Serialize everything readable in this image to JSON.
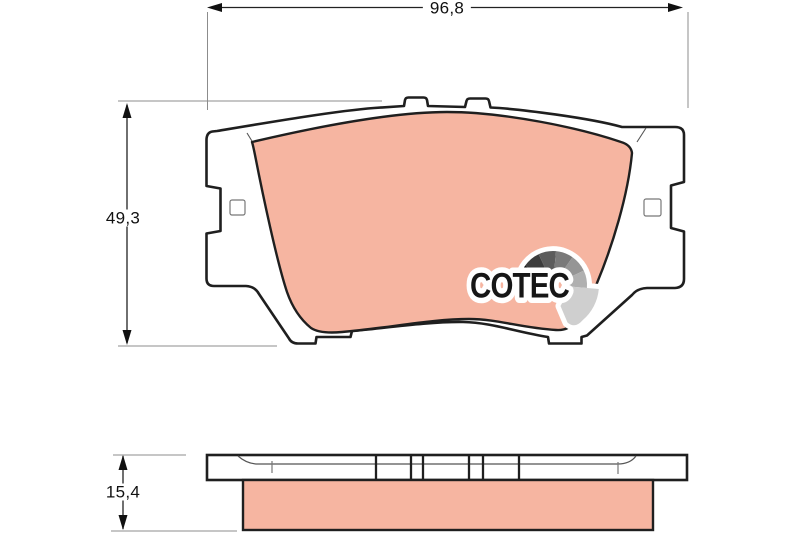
{
  "dimensions": {
    "width": "96,8",
    "height": "49,3",
    "thickness": "15,4"
  },
  "logo": {
    "text": "COTEC"
  },
  "colors": {
    "friction_material": "#f6b5a1",
    "outline": "#1f1f1f",
    "dimension_line": "#8c8c8c",
    "logo_text": "#161616",
    "logo_fan": [
      "#111111",
      "#3d3d3d",
      "#5c5c5c",
      "#7a7a7a",
      "#959595",
      "#b0b0b0",
      "#cfcfcf"
    ]
  }
}
